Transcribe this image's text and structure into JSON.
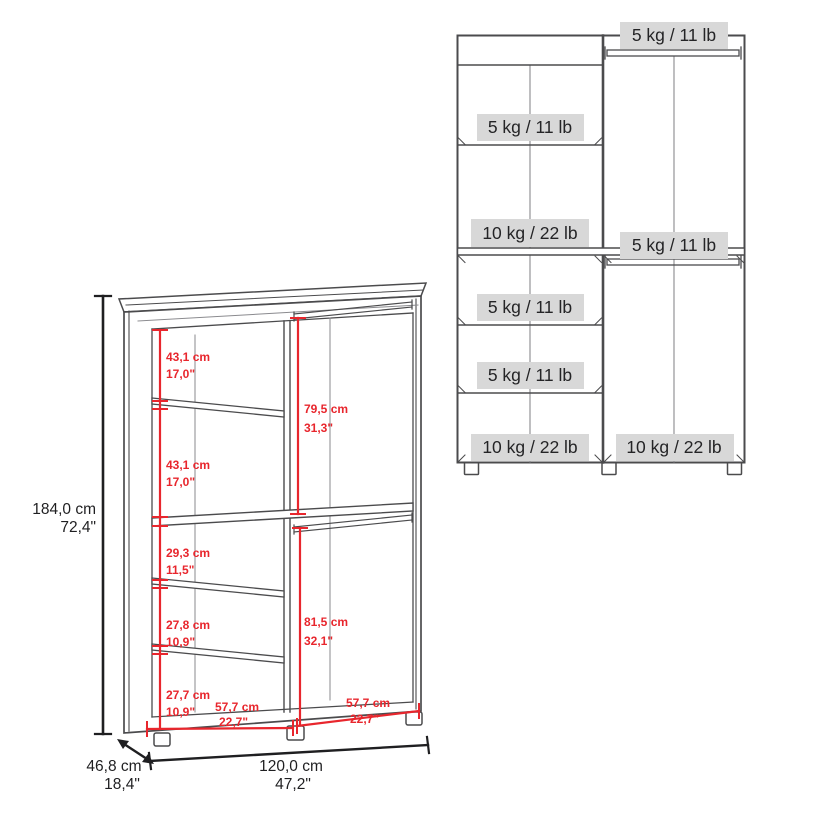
{
  "colors": {
    "red": "#e8262d",
    "line": "#4b4b4d",
    "seam": "#8a8a8e",
    "badge_bg": "#d8d8d8",
    "text": "#1f1f21"
  },
  "left_diagram": {
    "title": "wardrobe-dimension-view",
    "overall": {
      "height": {
        "cm": "184,0 cm",
        "inch": "72,4\""
      },
      "width": {
        "cm": "120,0 cm",
        "inch": "47,2\""
      },
      "depth": {
        "cm": "46,8 cm",
        "inch": "18,4\""
      }
    },
    "sections": {
      "left_top_1": {
        "cm": "43,1 cm",
        "inch": "17,0\""
      },
      "left_top_2": {
        "cm": "43,1 cm",
        "inch": "17,0\""
      },
      "right_upper": {
        "cm": "79,5 cm",
        "inch": "31,3\""
      },
      "left_mid": {
        "cm": "29,3 cm",
        "inch": "11,5\""
      },
      "left_lower_1": {
        "cm": "27,8 cm",
        "inch": "10,9\""
      },
      "left_lower_2": {
        "cm": "27,7 cm",
        "inch": "10,9\""
      },
      "right_lower": {
        "cm": "81,5 cm",
        "inch": "32,1\""
      },
      "bottom_left_width": {
        "cm": "57,7 cm",
        "inch": "22,7\""
      },
      "bottom_right_width": {
        "cm": "57,7 cm",
        "inch": "22,7\""
      }
    }
  },
  "right_diagram": {
    "title": "wardrobe-load-capacity-view",
    "badges": {
      "top_rod": "5 kg / 11 lb",
      "left_shelf_1": "5 kg / 11 lb",
      "left_shelf_2": "10 kg / 22 lb",
      "mid_rod": "5 kg / 11 lb",
      "left_shelf_3": "5 kg / 11 lb",
      "left_shelf_4": "5 kg / 11 lb",
      "left_bottom": "10 kg / 22 lb",
      "right_bottom": "10 kg / 22 lb"
    }
  }
}
